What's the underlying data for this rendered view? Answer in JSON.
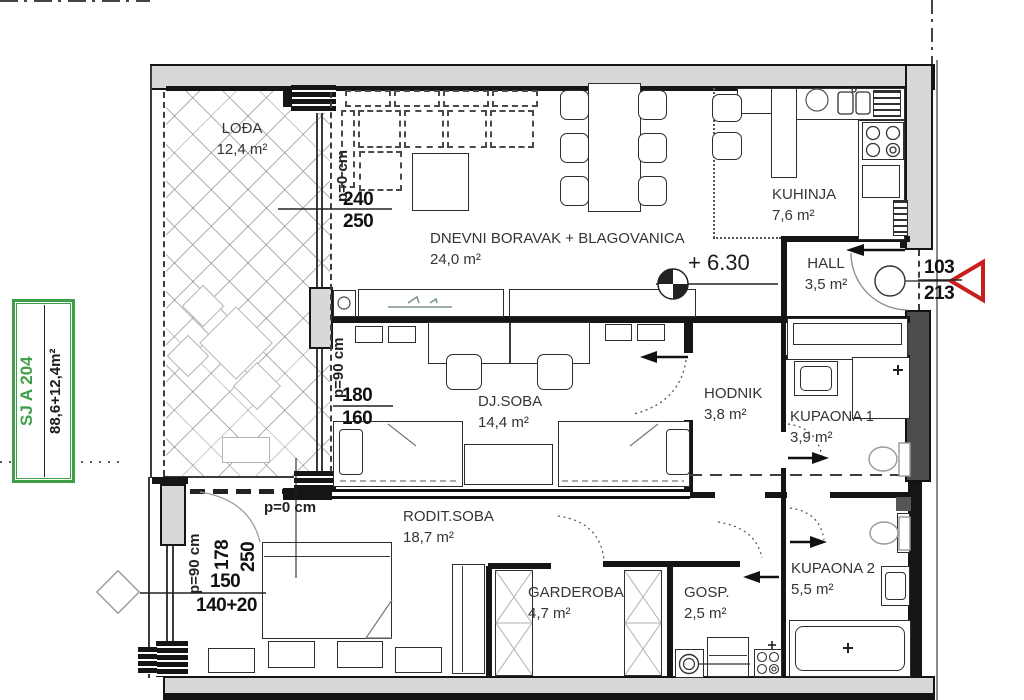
{
  "unit_badge": {
    "code": "SJ A 204",
    "area": "88,6+12,4m²"
  },
  "level_marker": {
    "value": "+ 6.30"
  },
  "rooms": {
    "lodja": {
      "name": "LOĐA",
      "area": "12,4 m²"
    },
    "dnevni": {
      "name": "DNEVNI BORAVAK + BLAGOVANICA",
      "area": "24,0 m²"
    },
    "kuhinja": {
      "name": "KUHINJA",
      "area": "7,6 m²"
    },
    "hall": {
      "name": "HALL",
      "area": "3,5 m²"
    },
    "hodnik": {
      "name": "HODNIK",
      "area": "3,8 m²"
    },
    "kupaona1": {
      "name": "KUPAONA 1",
      "area": "3,9 m²"
    },
    "djsoba": {
      "name": "DJ.SOBA",
      "area": "14,4 m²"
    },
    "roditsoba": {
      "name": "RODIT.SOBA",
      "area": "18,7 m²"
    },
    "garderoba": {
      "name": "GARDEROBA",
      "area": "4,7 m²"
    },
    "gosp": {
      "name": "GOSP.",
      "area": "2,5 m²"
    },
    "kupaona2": {
      "name": "KUPAONA 2",
      "area": "5,5 m²"
    }
  },
  "dimensions": {
    "balcony_door": {
      "width": "240",
      "height": "250",
      "parapet": "p=0 cm"
    },
    "dj_window": {
      "width": "180",
      "height": "160",
      "parapet": "p=90 cm"
    },
    "rodit_door": {
      "width": "178",
      "height": "250",
      "parapet": "p=0 cm"
    },
    "rodit_window": {
      "width": "150",
      "height": "140+20",
      "parapet": "p=90 cm"
    },
    "entry_door": {
      "width": "103",
      "height": "213"
    }
  },
  "colors": {
    "badge_green": "#3f9f47",
    "marker_red": "#c81e1e",
    "wall_fill": "#d8d8d8"
  }
}
